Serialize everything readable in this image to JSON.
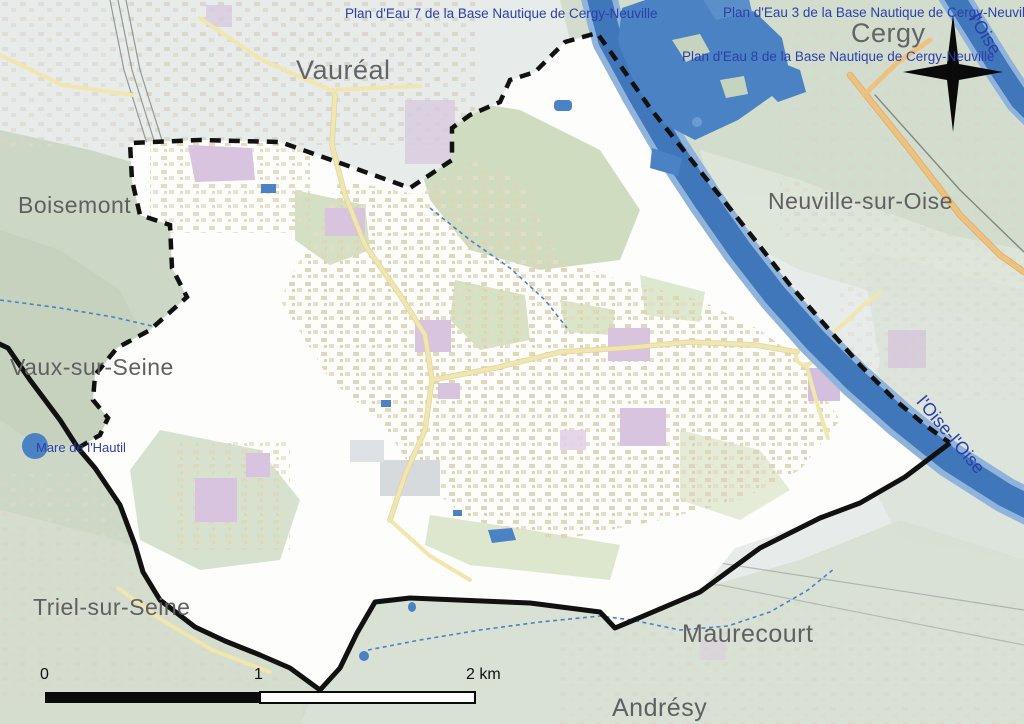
{
  "map_type": "commune-boundary-map",
  "place_labels": {
    "vaureal": "Vauréal",
    "cergy": "Cergy",
    "boisemont": "Boisemont",
    "neuville_sur_oise": "Neuville-sur-Oise",
    "vaux_sur_seine": "Vaux-sur-Seine",
    "triel_sur_seine": "Triel-sur-Seine",
    "maurecourt": "Maurecourt",
    "andresy": "Andrésy"
  },
  "water_labels": {
    "plan_eau_7": "Plan d'Eau 7 de la Base Nautique de Cergy-Neuville",
    "plan_eau_3": "Plan d'Eau 3 de la Base Nautique de Cergy-Neuville",
    "plan_eau_8": "Plan d'Eau 8 de la Base Nautique de Cergy-Neuville",
    "mare_hautil": "Mare de l'Hautil",
    "oise_upper": "l'Oise",
    "oise_lower": "l'Oise-l'Oise"
  },
  "scale_bar": {
    "tick_0": "0",
    "tick_1": "1",
    "tick_2": "2 km"
  },
  "colors": {
    "water": "#4a82c4",
    "water_edge": "#8fb3da",
    "label_blue": "#2b3fa8",
    "label_gray": "#5f6061",
    "boundary_black": "#111111",
    "commune_fill": "#fdfdfb",
    "muted_base": "#e7ebe9",
    "muted_green": "#ccd7c6",
    "bright_green": "#d3e2c0",
    "civic_purple": "#d9c4e0",
    "road_yellow": "#f0e6ae",
    "road_orange": "#eec17e"
  }
}
